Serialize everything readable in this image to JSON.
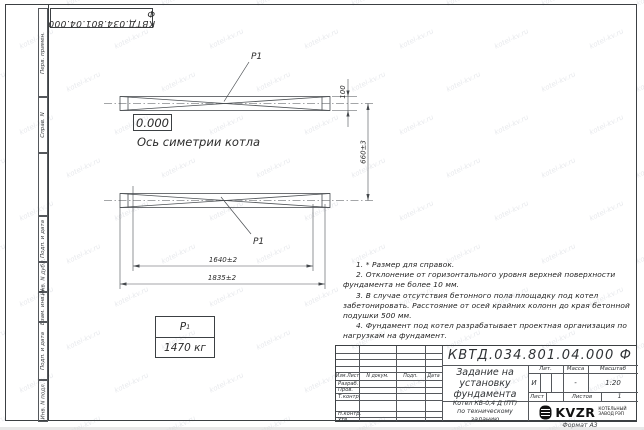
{
  "doc_number": "КВТД.034.801.04.000 Ф",
  "watermark": {
    "text": "kotel-kv.ru"
  },
  "sidebar": {
    "labels": [
      "Перв. примен.",
      "Справ. N",
      "Подп. и дата",
      "Инв. N дубл.",
      "Взам. инв. N",
      "Подп. и дата",
      "Инв. N подл."
    ]
  },
  "drawing": {
    "level_mark": "0.000",
    "axis_label": "Ось симетрии котла",
    "position_label": "P1",
    "dim_100": "100",
    "dim_660": "660±3",
    "dim_1640": "1640±2",
    "dim_1835": "1835±2"
  },
  "weight_table": {
    "symbol": "P",
    "symbol_sub": "1",
    "value": "1470 кг"
  },
  "notes": [
    "1. * Размер для справок.",
    "2. Отклонение от горизонтального уровня верхней поверхности фундамента не более 10 мм.",
    "3. В случае отсутствия бетонного пола площадку под котел забетонировать. Расстояние от осей крайних колонн до края бетонной подушки 500 мм.",
    "4. Фундамент под котел разрабатывает проектная организация по нагрузкам на фундамент."
  ],
  "title_block": {
    "title": "Задание на установку фундамента",
    "product_line1": "Котел  КВ-0,4  Д  (ПТ)",
    "product_line2": "по техническому заданию",
    "header_cols": [
      "Изм.Лист",
      "N докум.",
      "Подп.",
      "Дата"
    ],
    "row_labels": [
      "Разраб.",
      "Пров.",
      "Т.контр.",
      "Н.контр.",
      "Утв."
    ],
    "lit_header": "Лит.",
    "lit_value": "И",
    "mass_header": "Масса",
    "mass_value": "-",
    "scale_header": "Масштаб",
    "scale_value": "1:20",
    "sheet_label": "Лист",
    "sheets_label": "Листов",
    "sheets_value": "1",
    "logo_text": "KVZR",
    "logo_caption1": "КОТЕЛЬНЫЙ",
    "logo_caption2": "ЗАВОД РЭП",
    "format_label": "Формат А3"
  }
}
